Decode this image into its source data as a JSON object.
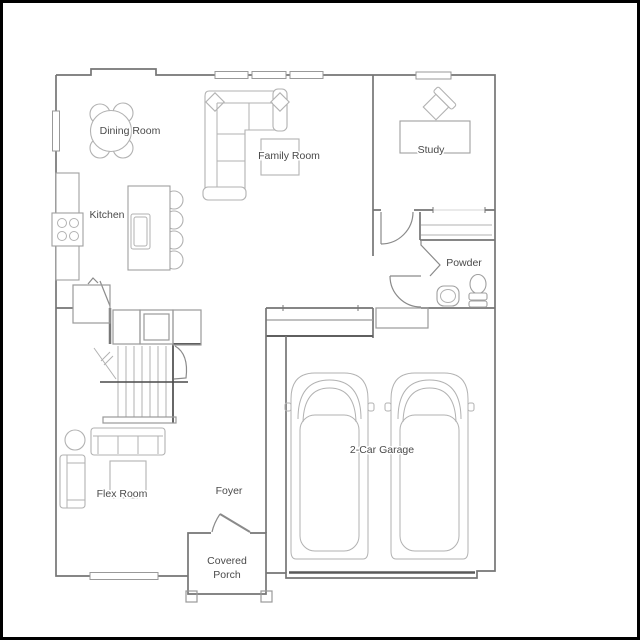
{
  "colors": {
    "frame_border": "#000000",
    "background": "#ffffff",
    "wall": "#757575",
    "wall_dark": "#5f5f5f",
    "furniture": "#b2b2b2",
    "garage_door": "#5a5a5a",
    "label_text": "#4a4a4a"
  },
  "rooms": {
    "dining": {
      "label": "Dining Room"
    },
    "family": {
      "label": "Family Room"
    },
    "study": {
      "label": "Study"
    },
    "kitchen": {
      "label": "Kitchen"
    },
    "powder": {
      "label": "Powder"
    },
    "garage": {
      "label": "2-Car Garage"
    },
    "flex": {
      "label": "Flex Room"
    },
    "foyer": {
      "label": "Foyer"
    },
    "porch": {
      "line1": "Covered",
      "line2": "Porch"
    }
  }
}
